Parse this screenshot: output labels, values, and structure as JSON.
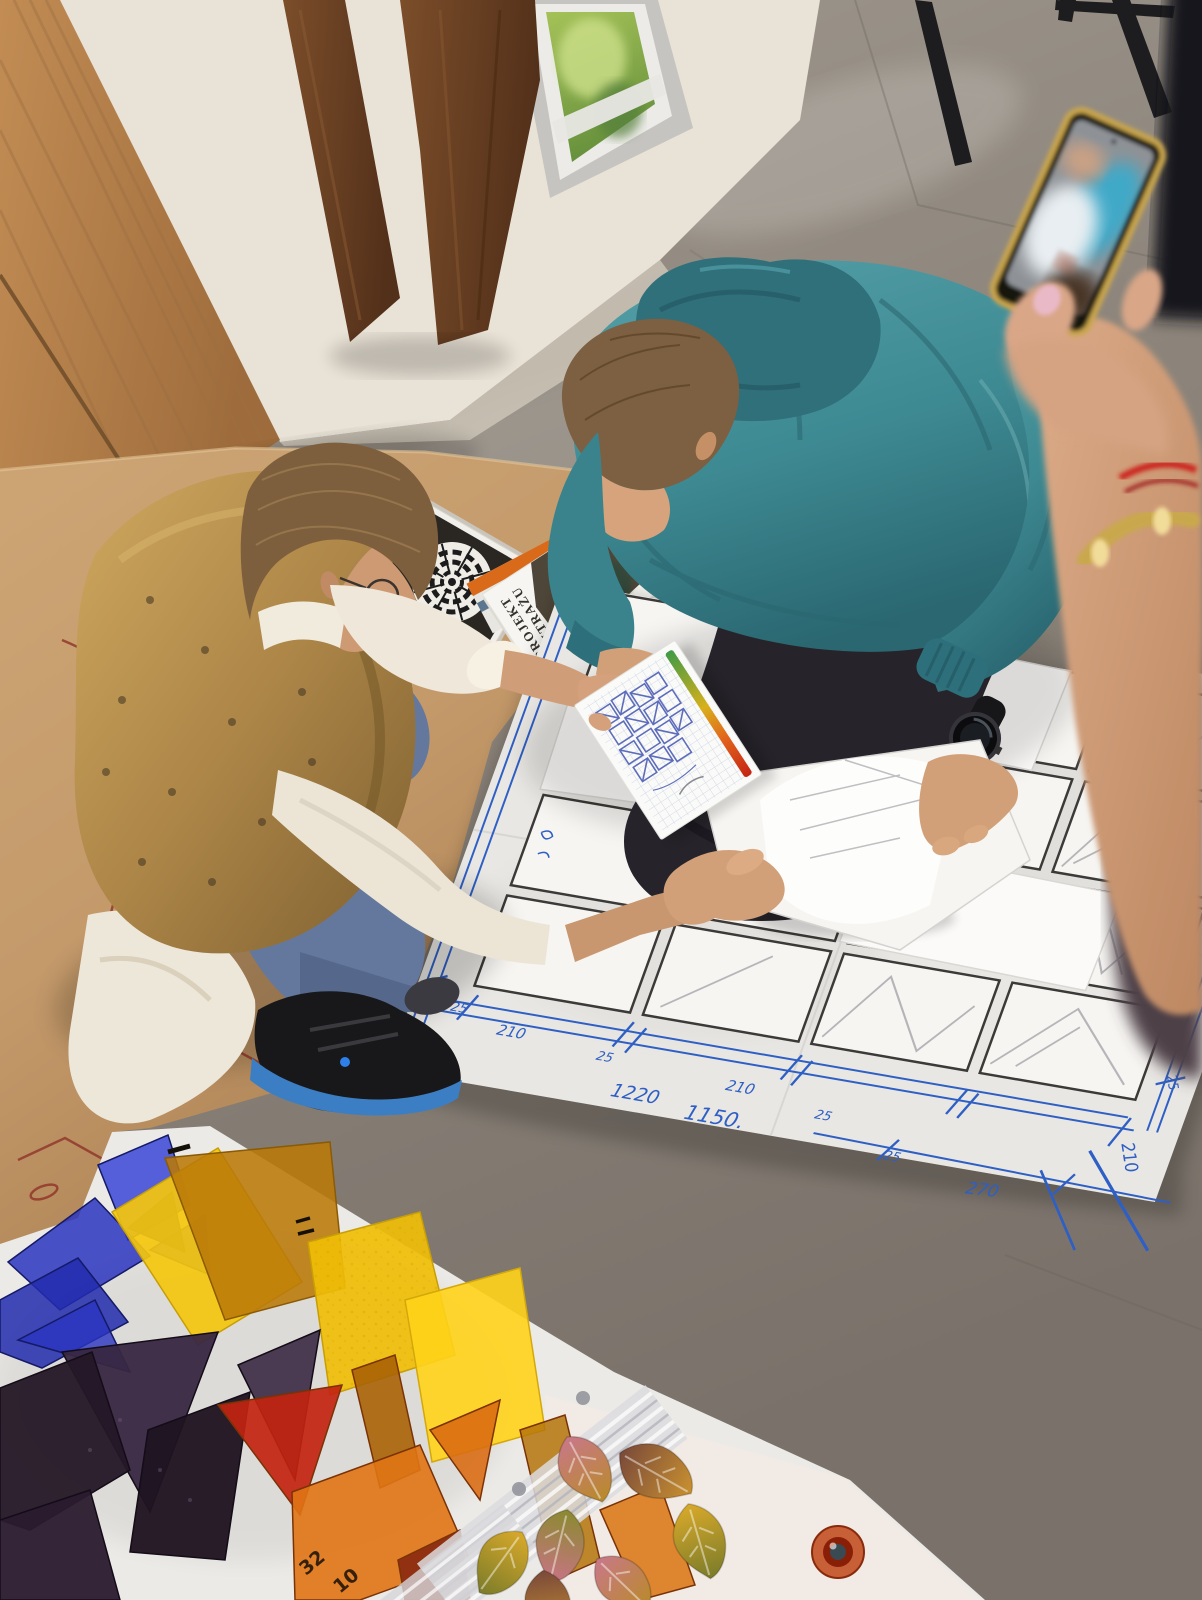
{
  "scene": {
    "description": "Stained-glass workshop photographed from above: an instructor in a gold patterned vest and a teenage student in a teal hoodie crouch on a grey floor over a large white window-layout plan drawn with a black grid and blue pen dimensions; the instructor points at a small graph-paper sketch while template sheets are exchanged; a bystander photographs the scene with a gold-framed phone; sheets of blue, yellow, amber, orange, red and purple glass plus molded glass leaves lie on white paper in the foreground.",
    "blueprint": {
      "dims": [
        "210",
        "25",
        "210",
        "25",
        "1220",
        "1150.",
        "210",
        "25",
        "25",
        "270",
        "210",
        "25"
      ]
    },
    "booklet": {
      "title_line1": "PROJEKT",
      "title_line2": "WITRAŻU"
    },
    "glass_marks": [
      "32",
      "10"
    ],
    "palette": {
      "floor": "#8d857b",
      "kraft_paper": "#c49a6b",
      "blueprint_ink": "#2e5fc5",
      "hoodie_teal": "#3e8a93",
      "vest_gold": "#ad8648",
      "jeans_blue": "#64789e",
      "shoe_sole_blue": "#3c7ec4",
      "glass_yellow": "#f4c70e",
      "glass_blue": "#2b35c0",
      "glass_orange": "#e07414",
      "glass_red": "#c22410",
      "glass_purple": "#2e1f33",
      "phone_gold": "#c9a64e"
    }
  }
}
